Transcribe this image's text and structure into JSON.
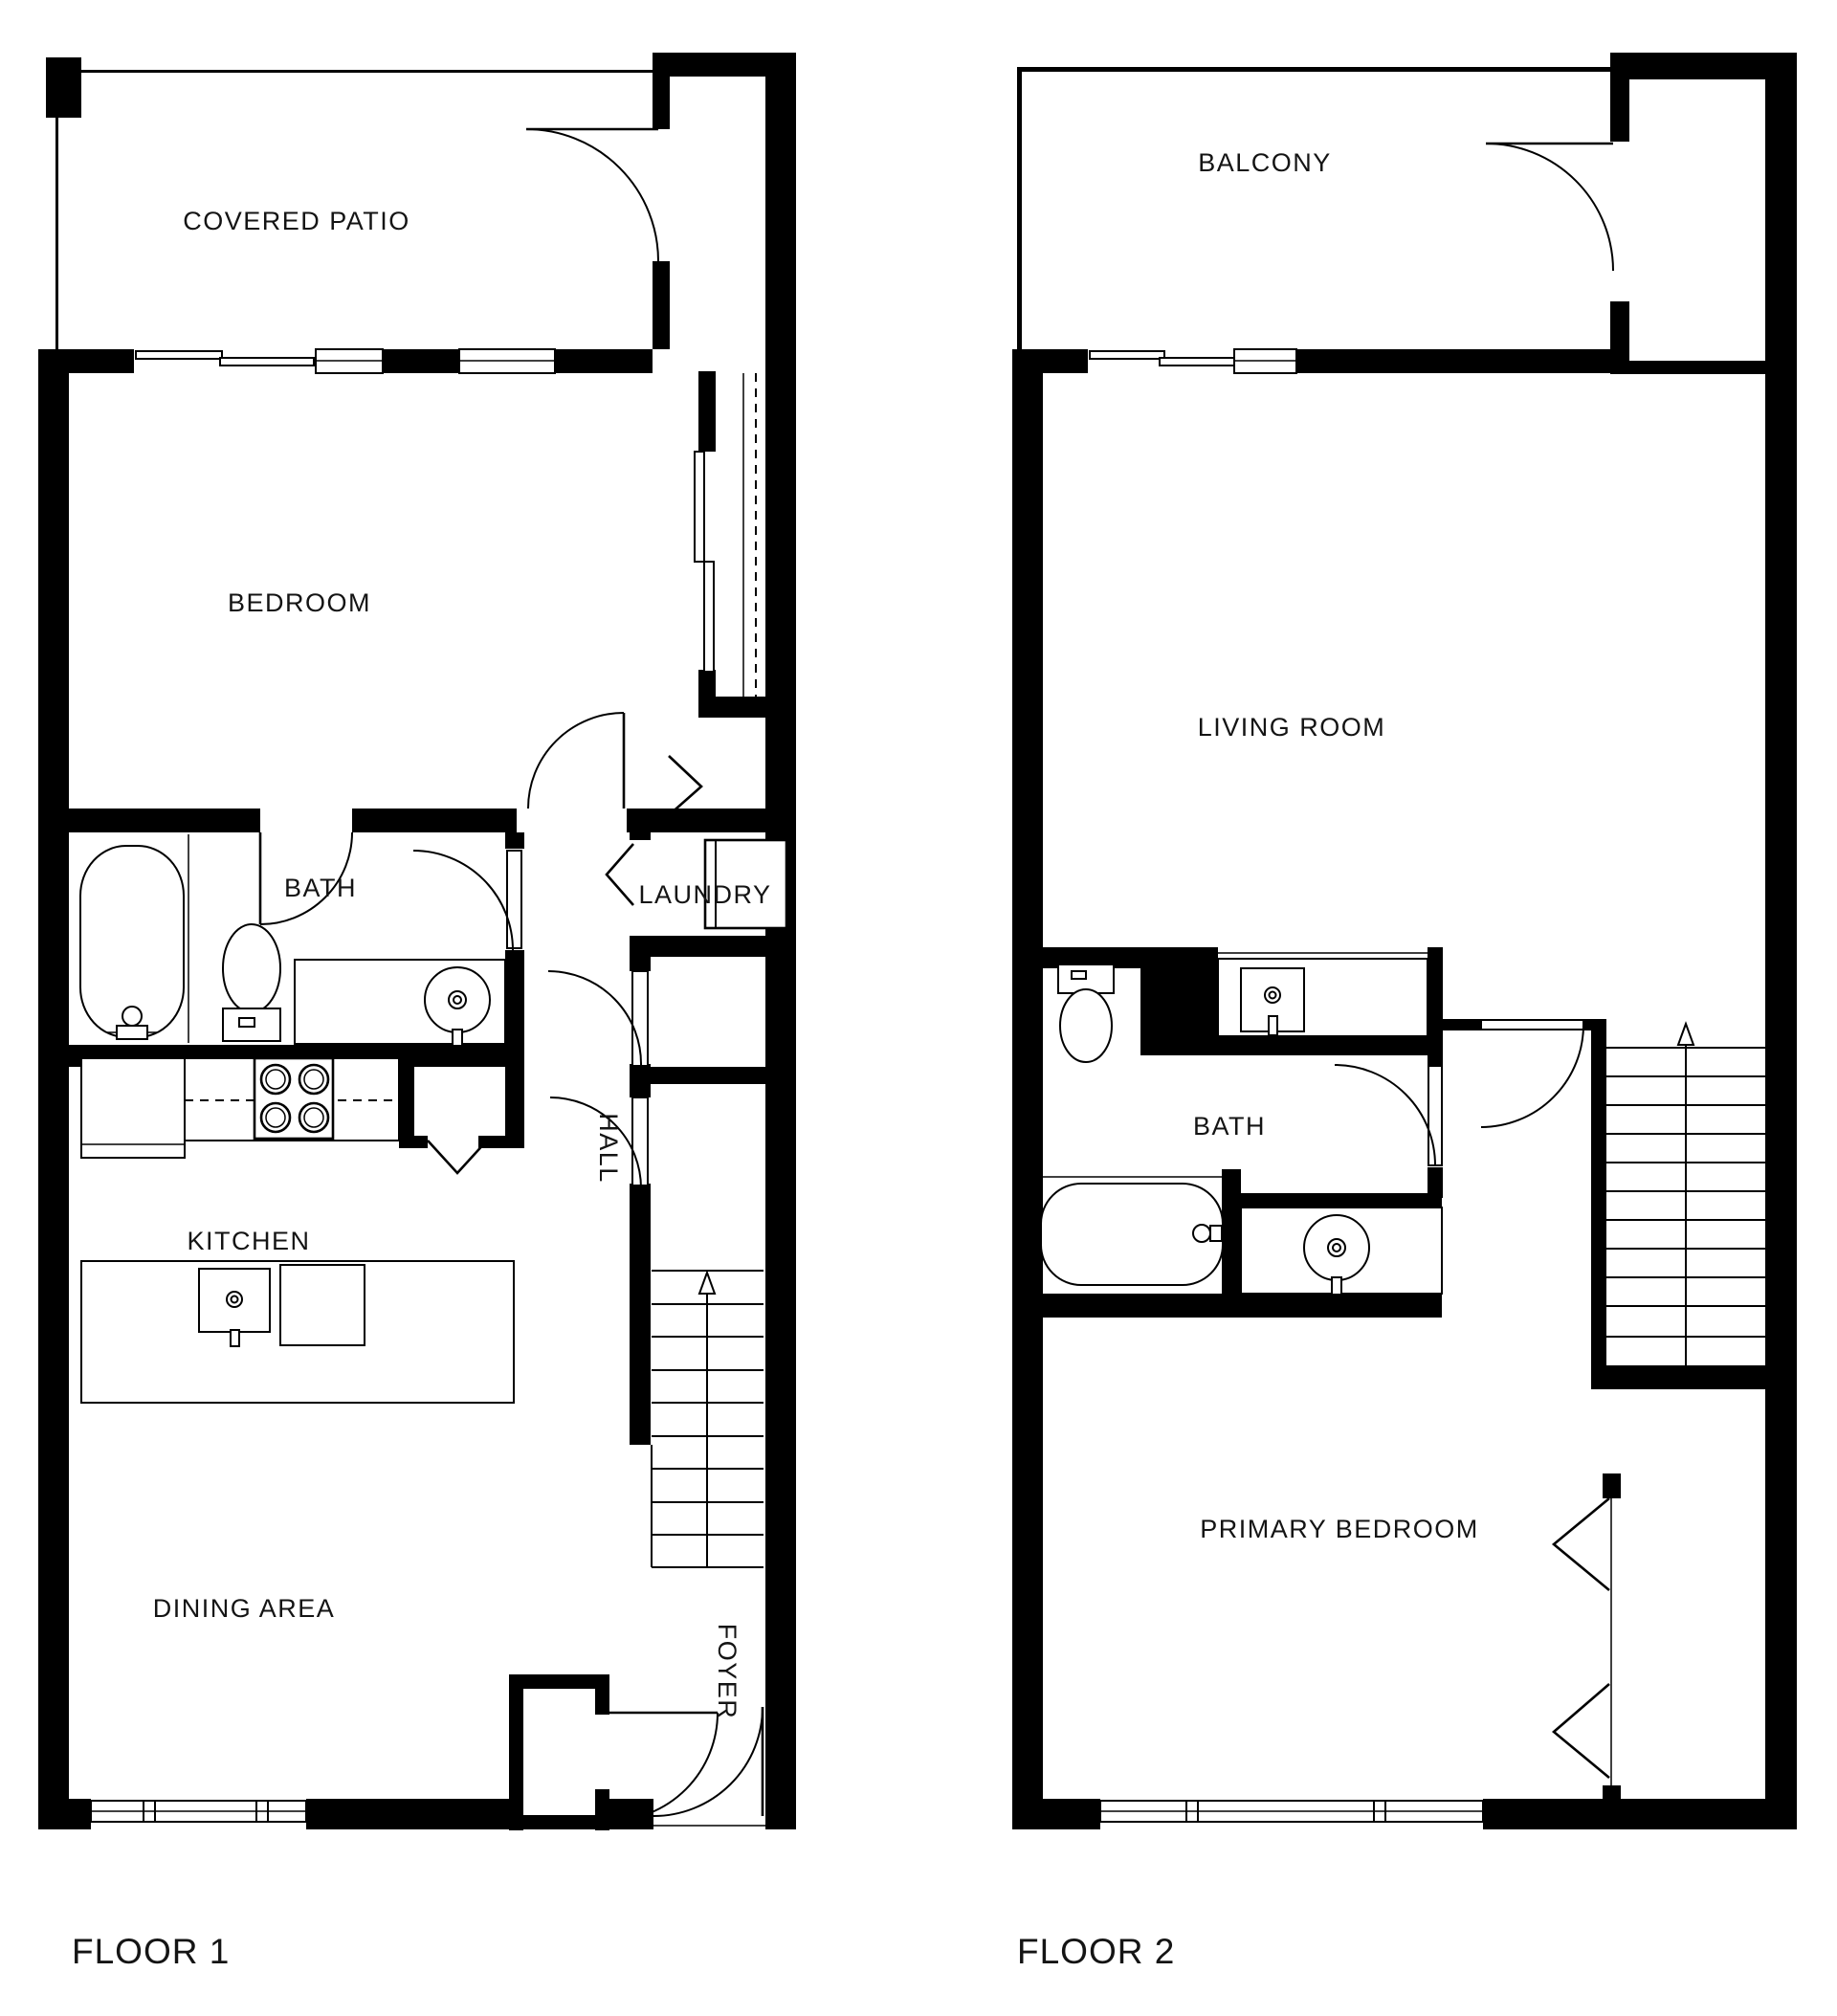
{
  "colors": {
    "wall": "#000000",
    "bg": "#ffffff",
    "ink": "#141414"
  },
  "floors": [
    {
      "label": "FLOOR 1",
      "rooms": {
        "patio": "COVERED PATIO",
        "bedroom": "BEDROOM",
        "bath": "BATH",
        "laundry": "LAUNDRY",
        "kitchen": "KITCHEN",
        "hall": "HALL",
        "dining": "DINING AREA",
        "foyer": "FOYER"
      }
    },
    {
      "label": "FLOOR 2",
      "rooms": {
        "balcony": "BALCONY",
        "living": "LIVING ROOM",
        "bath": "BATH",
        "primary": "PRIMARY BEDROOM"
      }
    }
  ]
}
